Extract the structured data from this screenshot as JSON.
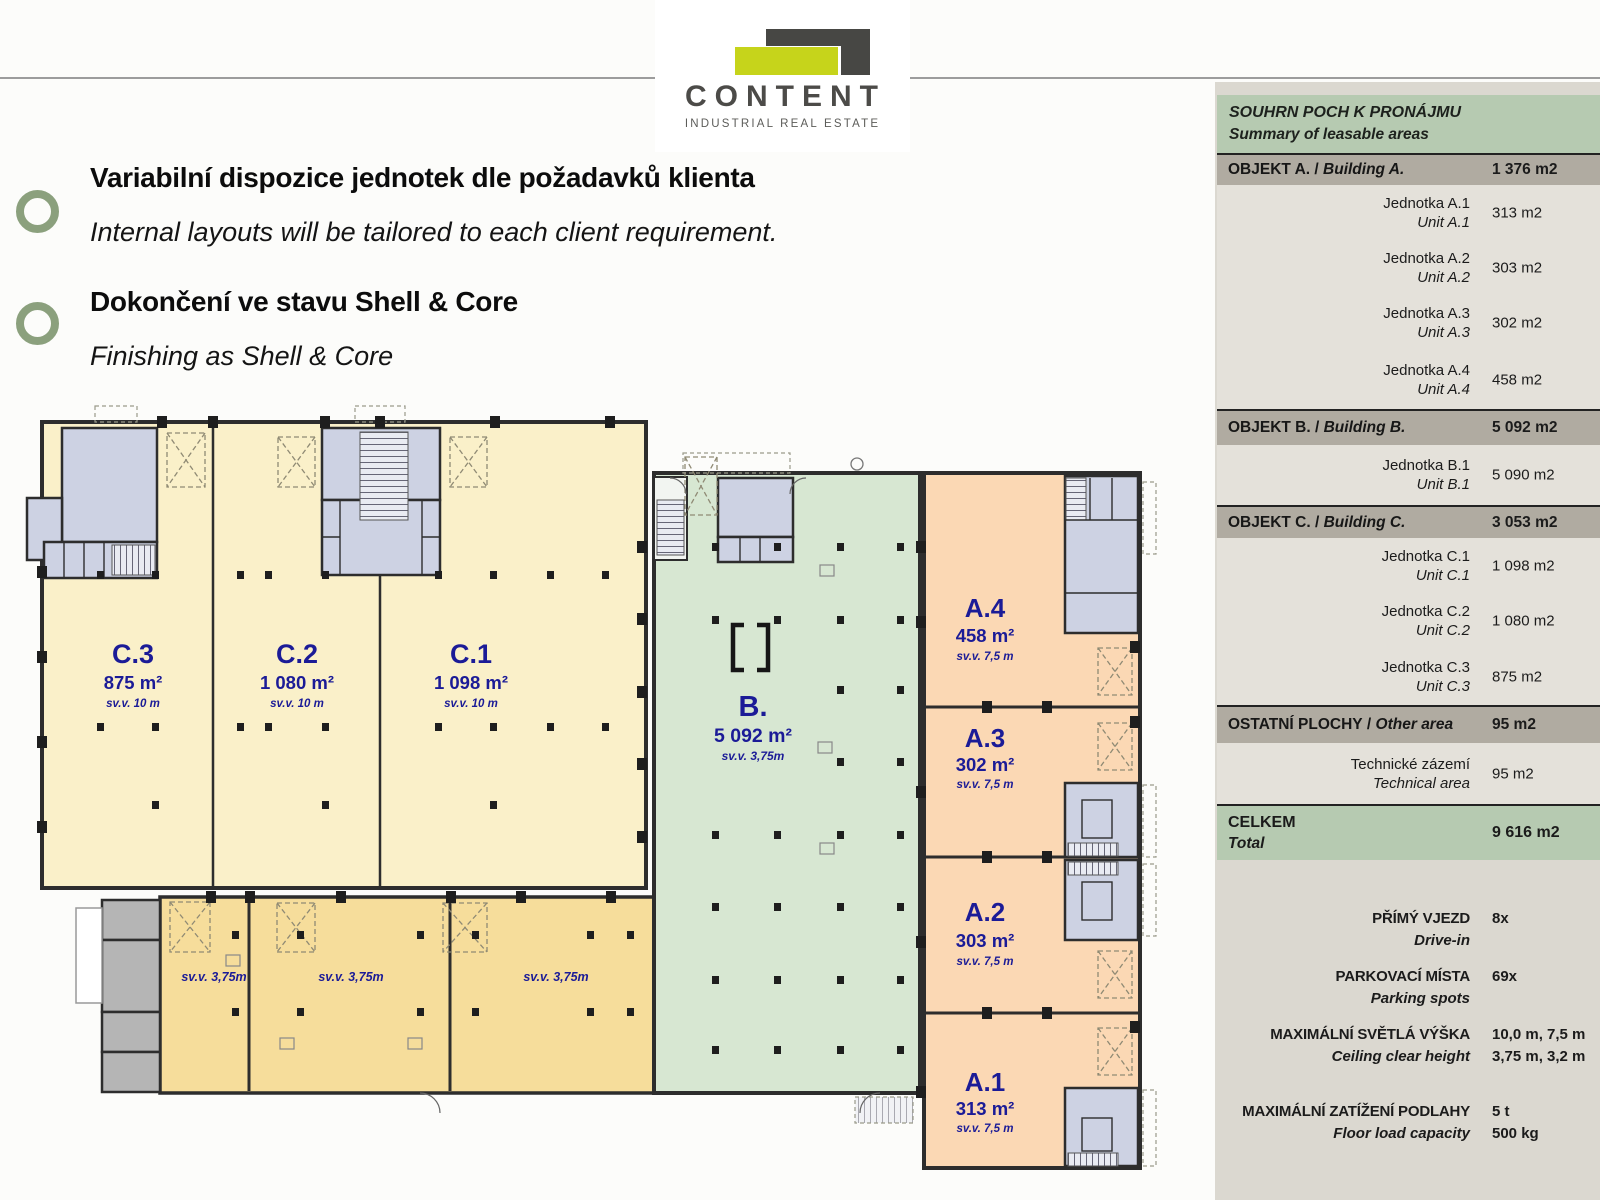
{
  "logo": {
    "name": "CONTENT",
    "tagline": "INDUSTRIAL REAL ESTATE",
    "accent": "#c6d41b",
    "dark": "#474744"
  },
  "bullets": [
    {
      "title": "Variabilní dispozice jednotek dle požadavků klienta",
      "subtitle": "Internal layouts will be tailored to each client requirement."
    },
    {
      "title": "Dokončení ve stavu Shell & Core",
      "subtitle": "Finishing as Shell & Core"
    }
  ],
  "plan": {
    "units": [
      {
        "id": "C.3",
        "area": "875 m²",
        "clear": "sv.v. 10 m"
      },
      {
        "id": "C.2",
        "area": "1 080 m²",
        "clear": "sv.v. 10 m"
      },
      {
        "id": "C.1",
        "area": "1 098 m²",
        "clear": "sv.v. 10 m"
      },
      {
        "id": "B.",
        "area": "5 092 m²",
        "clear": "sv.v. 3,75m"
      },
      {
        "id": "A.4",
        "area": "458 m²",
        "clear": "sv.v. 7,5 m"
      },
      {
        "id": "A.3",
        "area": "302 m²",
        "clear": "sv.v. 7,5 m"
      },
      {
        "id": "A.2",
        "area": "303 m²",
        "clear": "sv.v. 7,5 m"
      },
      {
        "id": "A.1",
        "area": "313 m²",
        "clear": "sv.v. 7,5 m"
      }
    ],
    "mezzanine": [
      "sv.v. 3,75m",
      "sv.v. 3,75m",
      "sv.v. 3,75m"
    ],
    "colors": {
      "hall_c": "#faf0c9",
      "mezzanine": "#f6dd9b",
      "hall_b": "#d7e7d2",
      "hall_a": "#fbd8b4",
      "technical": "#cdd2e3",
      "service": "#b5b5b5",
      "wall": "#2d2d2d",
      "label": "#1b1b97"
    }
  },
  "summary": {
    "slash": " / ",
    "title": "SOUHRN POCH K PRONÁJMU",
    "subtitle": "Summary of leasable areas",
    "sections": [
      {
        "cz": "OBJEKT A.",
        "en": "Building A.",
        "value": "1 376 m2",
        "rows": [
          {
            "cz": "Jednotka A.1",
            "en": "Unit A.1",
            "value": "313 m2"
          },
          {
            "cz": "Jednotka A.2",
            "en": "Unit A.2",
            "value": "303 m2"
          },
          {
            "cz": "Jednotka A.3",
            "en": "Unit A.3",
            "value": "302 m2"
          },
          {
            "cz": "Jednotka A.4",
            "en": "Unit A.4",
            "value": "458 m2"
          }
        ]
      },
      {
        "cz": "OBJEKT B.",
        "en": "Building B.",
        "value": "5 092 m2",
        "rows": [
          {
            "cz": "Jednotka B.1",
            "en": "Unit B.1",
            "value": "5 090 m2"
          }
        ]
      },
      {
        "cz": "OBJEKT C.",
        "en": "Building C.",
        "value": "3 053 m2",
        "rows": [
          {
            "cz": "Jednotka C.1",
            "en": "Unit C.1",
            "value": "1 098 m2"
          },
          {
            "cz": "Jednotka C.2",
            "en": "Unit C.2",
            "value": "1 080 m2"
          },
          {
            "cz": "Jednotka C.3",
            "en": "Unit C.3",
            "value": "875 m2"
          }
        ]
      },
      {
        "cz": "OSTATNÍ PLOCHY",
        "en": "Other area",
        "value": "95 m2",
        "rows": [
          {
            "cz": "Technické zázemí",
            "en": "Technical area",
            "value": "95 m2"
          }
        ]
      }
    ],
    "total": {
      "cz": "CELKEM",
      "en": "Total",
      "value": "9 616 m2"
    },
    "facts": [
      {
        "cz": "PŘÍMÝ VJEZD",
        "en": "Drive-in",
        "v1": "8x",
        "v2": ""
      },
      {
        "cz": "PARKOVACÍ MÍSTA",
        "en": "Parking spots",
        "v1": "69x",
        "v2": ""
      },
      {
        "cz": "MAXIMÁLNÍ SVĚTLÁ VÝŠKA",
        "en": "Ceiling clear height",
        "v1": "10,0 m, 7,5 m",
        "v2": "3,75 m,  3,2 m"
      },
      {
        "cz": "MAXIMÁLNÍ ZATÍŽENÍ PODLAHY",
        "en": "Floor load capacity",
        "v1": "5 t",
        "v2": "500 kg"
      }
    ]
  }
}
